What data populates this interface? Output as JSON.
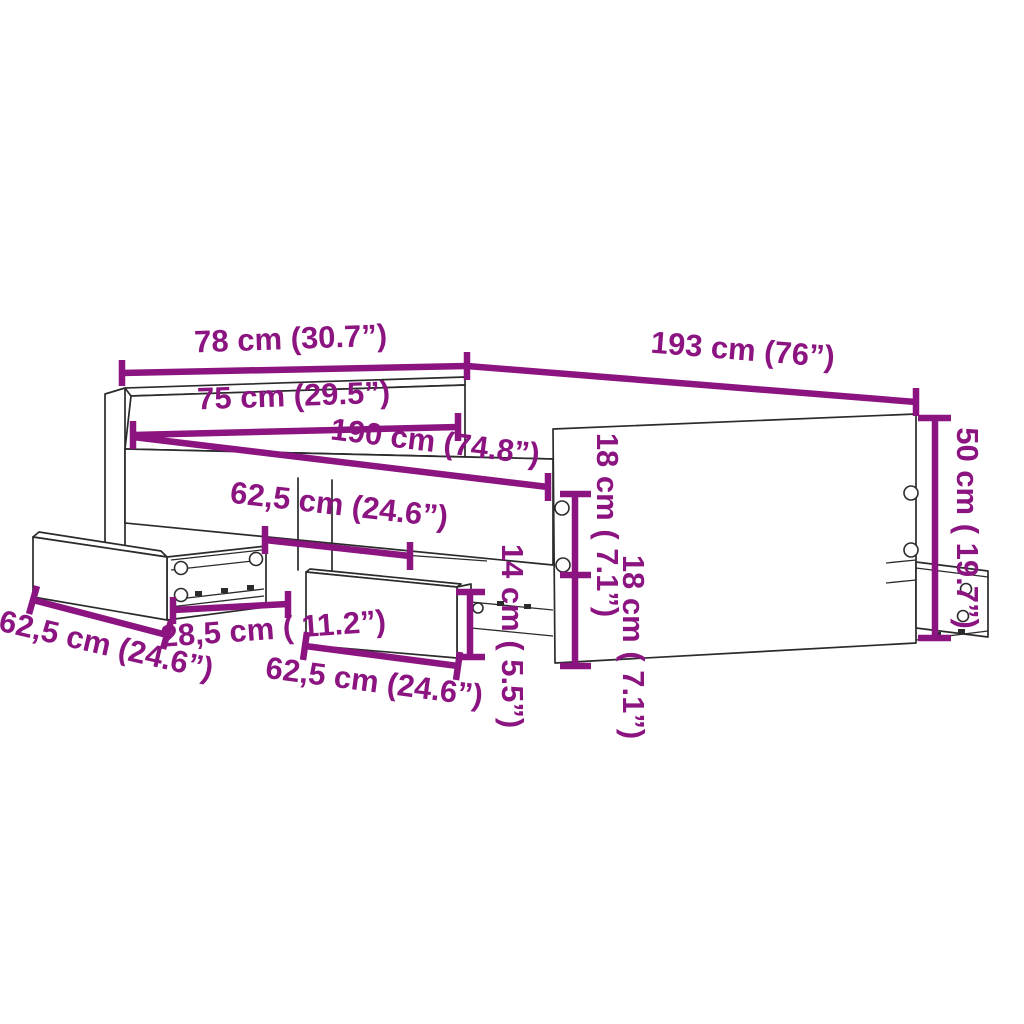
{
  "diagram": {
    "title": "Bed frame with drawers dimension diagram",
    "colors": {
      "dimension": "#8B1480",
      "line": "#2b2b2b",
      "background": "#ffffff"
    },
    "dimensions": {
      "overall_width": {
        "label": "78 cm (30.7”)",
        "value_cm": 78,
        "value_in": 30.7
      },
      "overall_length": {
        "label": "193 cm (76”)",
        "value_cm": 193,
        "value_in": 76
      },
      "inner_width": {
        "label": "75 cm (29.5”)",
        "value_cm": 75,
        "value_in": 29.5
      },
      "inner_length": {
        "label": "190 cm (74.8”)",
        "value_cm": 190,
        "value_in": 74.8
      },
      "drawer2_width_top": {
        "label": "62,5 cm (24.6”)",
        "value_cm": 62.5,
        "value_in": 24.6
      },
      "drawer1_width": {
        "label": "62,5 cm (24.6”)",
        "value_cm": 62.5,
        "value_in": 24.6
      },
      "drawer2_width_bottom": {
        "label": "62,5 cm (24.6”)",
        "value_cm": 62.5,
        "value_in": 24.6
      },
      "drawer_side_depth": {
        "label": "28,5 cm ( 11.2”)",
        "value_cm": 28.5,
        "value_in": 11.2
      },
      "drawer_height": {
        "label": "14 cm ( 5.5”)",
        "value_cm": 14,
        "value_in": 5.5
      },
      "panel_hole_upper": {
        "label": "18 cm ( 7.1”)",
        "value_cm": 18,
        "value_in": 7.1
      },
      "panel_hole_lower": {
        "label": "18 cm ( 7.1”)",
        "value_cm": 18,
        "value_in": 7.1
      },
      "side_panel_height": {
        "label": "50 cm ( 19.7”)",
        "value_cm": 50,
        "value_in": 19.7
      }
    }
  }
}
